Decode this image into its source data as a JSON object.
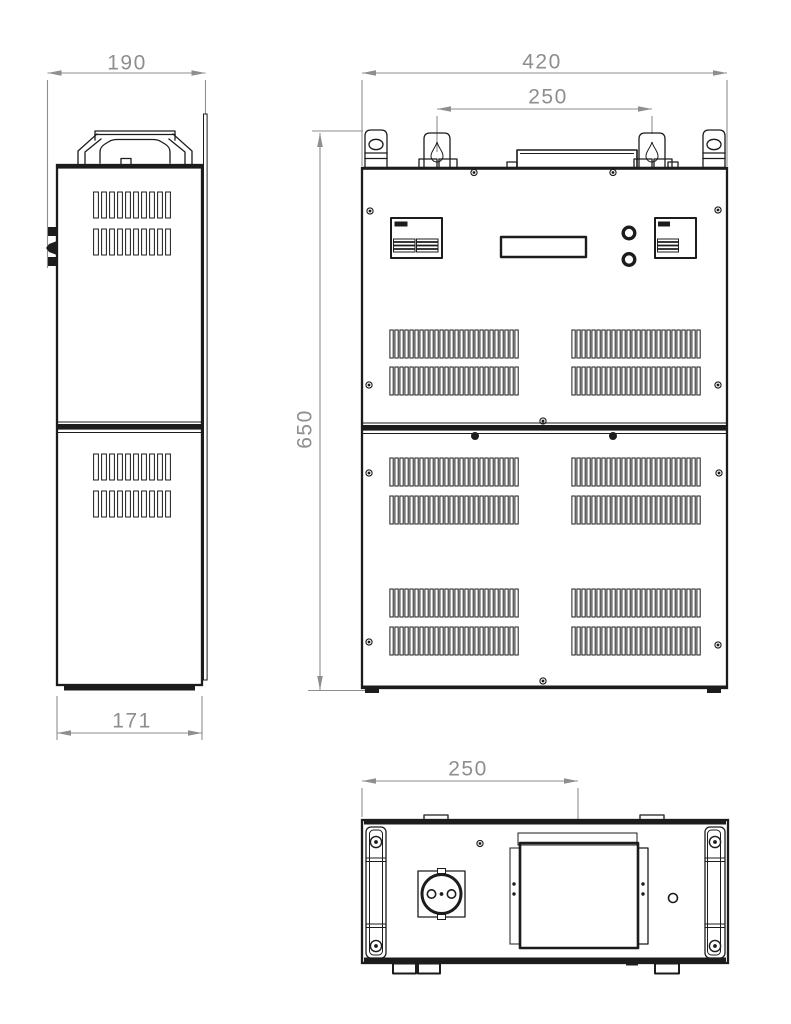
{
  "drawing": {
    "kind": "orthographic-technical-drawing",
    "background": "#ffffff",
    "line_color": "#1c1c1c",
    "dimension_color": "#8e8e8e",
    "dimensions": {
      "side_overall_width": "190",
      "side_base_width": "171",
      "front_overall_width": "420",
      "front_hanger_spacing": "250",
      "front_overall_height": "650",
      "bottom_cover_offset": "250"
    }
  }
}
